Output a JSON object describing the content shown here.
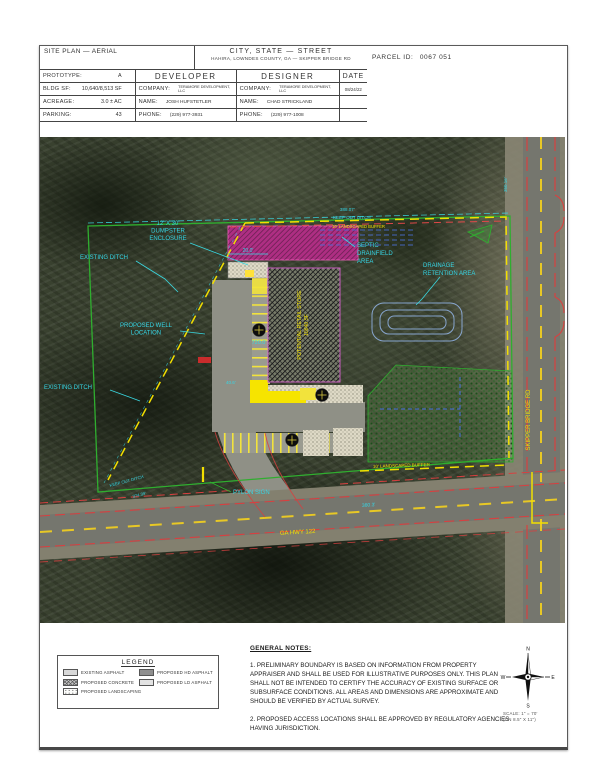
{
  "title_block": {
    "sheet_title": "SITE PLAN — AERIAL",
    "location_title": "CITY, STATE — STREET",
    "location_subtitle": "HAHIRA, LOWNDES COUNTY, GA — SKIPPER BRIDGE RD",
    "parcel_label": "PARCEL ID:",
    "parcel_value": "0067 051",
    "fields": [
      {
        "label": "PROTOTYPE:",
        "value": "A"
      },
      {
        "label": "BLDG SF:",
        "value": "10,640/8,513 SF"
      },
      {
        "label": "ACREAGE:",
        "value": "3.0 ± AC"
      },
      {
        "label": "PARKING:",
        "value": "43"
      }
    ],
    "developer": {
      "header": "DEVELOPER",
      "company_label": "COMPANY:",
      "company": "TERAMORE DEVELOPMENT, LLC",
      "name_label": "NAME:",
      "name": "JOSH HUFSTETLER",
      "phone_label": "PHONE:",
      "phone": "(229) 977-3931"
    },
    "designer": {
      "header": "DESIGNER",
      "company_label": "COMPANY:",
      "company": "TERAMORE DEVELOPMENT, LLC",
      "name_label": "NAME:",
      "name": "CHAD STRICKLAND",
      "phone_label": "PHONE:",
      "phone": "(229) 977-1008"
    },
    "date_header": "DATE",
    "date_value": "08/24/22"
  },
  "plan": {
    "dumpster_l1": "12' X 30'",
    "dumpster_l2": "DUMPSTER",
    "dumpster_l3": "ENCLOSURE",
    "existing_ditch_1": "EXISTING DITCH",
    "existing_ditch_2": "EXISTING DITCH",
    "well_l1": "PROPOSED WELL",
    "well_l2": "LOCATION",
    "septic_l1": "SEPTIC",
    "septic_l2": "DRAINFIELD",
    "septic_l3": "AREA",
    "drainage_l1": "DRAINAGE",
    "drainage_l2": "RETENTION AREA",
    "pylon_sign": "PYLON SIGN",
    "keep_out_top": "KEEP OUT DITCH",
    "keep_out_left": "KEEP OUT DITCH",
    "dim_388": "388.07'",
    "dim_374": "374.39'",
    "dim_360": "360.3'",
    "dim_350": "350.16'",
    "dim_720": "720.0'",
    "dim_20": "20.0'",
    "dim_40": "40.6'",
    "buffer_top": "10' LANDSCAPED BUFFER",
    "buffer_bottom": "10' LANDSCAPED BUFFER",
    "skipper_rd": "SKIPPER BRIDGE RD",
    "ga_hwy": "GA HWY 122",
    "building_l1": "POTENTIAL RETAIL STORE",
    "building_l2": "10640 SF"
  },
  "legend": {
    "title": "LEGEND",
    "items": [
      {
        "label": "EXISTING ASPHALT",
        "swatch": "existing-asphalt"
      },
      {
        "label": "PROPOSED HD ASPHALT",
        "swatch": "proposed-hd-asphalt"
      },
      {
        "label": "PROPOSED CONCRETE",
        "swatch": "proposed-concrete"
      },
      {
        "label": "PROPOSED LD ASPHALT",
        "swatch": "proposed-ld-asphalt"
      },
      {
        "label": "PROPOSED LANDSCAPING",
        "swatch": "proposed-landscaping"
      }
    ]
  },
  "notes": {
    "heading": "GENERAL NOTES:",
    "note1": "1. PRELIMINARY BOUNDARY IS BASED ON INFORMATION FROM PROPERTY APPRAISER AND SHALL BE USED FOR ILLUSTRATIVE PURPOSES ONLY. THIS PLAN SHALL NOT BE INTENDED TO CERTIFY THE ACCURACY OF EXISTING SURFACE OR SUBSURFACE CONDITIONS.  ALL AREAS AND DIMENSIONS ARE APPROXIMATE AND SHOULD BE VERIFIED BY ACTUAL SURVEY.",
    "note2": "2. PROPOSED ACCESS LOCATIONS SHALL BE APPROVED BY REGULATORY AGENCIES HAVING JURISDICTION."
  },
  "compass": {
    "n": "N",
    "e": "E",
    "s": "S",
    "w": "W"
  },
  "scale": {
    "line1": "SCALE: 1\" = 70'",
    "line2": "(ON 8.5\" X 11\")"
  },
  "colors": {
    "label_cyan": "#35d6e6",
    "label_yellow": "#f2e000",
    "boundary_green": "#2fae2f",
    "road_edge_red": "#d84040",
    "buffer_magenta": "#bf2e8e"
  }
}
